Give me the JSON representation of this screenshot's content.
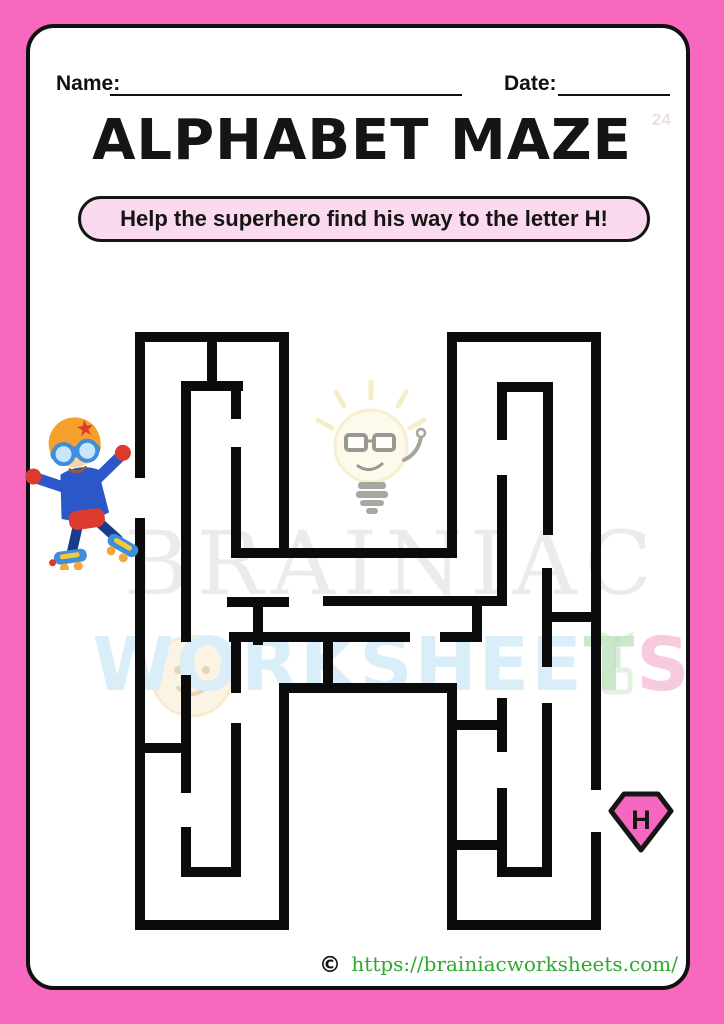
{
  "page": {
    "frame_color": "#F868BE",
    "card_bg": "#FFFFFF",
    "name_label": "Name:",
    "date_label": "Date:",
    "corner_number": "24",
    "title": "ALPHABET MAZE",
    "instruction": "Help the superhero find his way to the letter H!",
    "pill_bg": "#FBD9EE"
  },
  "watermark": {
    "line1": "BRAINIAC",
    "line2_main": "WORKSHEE",
    "line2_t": "T",
    "line2_s": "S"
  },
  "maze": {
    "letter_shape": "H",
    "wall_color": "#0B0B0B",
    "wall_width": 10,
    "entrance_side": "left",
    "exit_side": "right",
    "segments": [
      [
        140,
        337,
        284,
        337
      ],
      [
        140,
        337,
        140,
        473
      ],
      [
        140,
        523,
        140,
        925
      ],
      [
        140,
        925,
        284,
        925
      ],
      [
        284,
        337,
        284,
        553
      ],
      [
        284,
        553,
        452,
        553
      ],
      [
        452,
        337,
        452,
        553
      ],
      [
        452,
        337,
        596,
        337
      ],
      [
        596,
        337,
        596,
        785
      ],
      [
        596,
        837,
        596,
        925
      ],
      [
        452,
        925,
        596,
        925
      ],
      [
        452,
        688,
        452,
        925
      ],
      [
        284,
        688,
        452,
        688
      ],
      [
        284,
        688,
        284,
        925
      ],
      [
        212,
        337,
        212,
        386
      ],
      [
        188,
        386,
        238,
        386
      ],
      [
        236,
        386,
        236,
        414
      ],
      [
        186,
        386,
        186,
        637
      ],
      [
        236,
        452,
        236,
        553
      ],
      [
        236,
        553,
        284,
        553
      ],
      [
        140,
        748,
        186,
        748
      ],
      [
        186,
        680,
        186,
        788
      ],
      [
        236,
        728,
        236,
        872
      ],
      [
        186,
        872,
        236,
        872
      ],
      [
        186,
        832,
        186,
        872
      ],
      [
        232,
        602,
        284,
        602
      ],
      [
        258,
        602,
        258,
        640
      ],
      [
        234,
        637,
        405,
        637
      ],
      [
        236,
        637,
        236,
        688
      ],
      [
        328,
        601,
        502,
        601
      ],
      [
        328,
        637,
        328,
        688
      ],
      [
        477,
        601,
        477,
        637
      ],
      [
        445,
        637,
        477,
        637
      ],
      [
        502,
        387,
        502,
        435
      ],
      [
        502,
        387,
        548,
        387
      ],
      [
        548,
        387,
        548,
        530
      ],
      [
        502,
        480,
        502,
        601
      ],
      [
        547,
        573,
        547,
        662
      ],
      [
        547,
        617,
        596,
        617
      ],
      [
        452,
        725,
        502,
        725
      ],
      [
        502,
        703,
        502,
        747
      ],
      [
        452,
        845,
        502,
        845
      ],
      [
        502,
        793,
        502,
        872
      ],
      [
        502,
        872,
        547,
        872
      ],
      [
        547,
        708,
        547,
        872
      ]
    ]
  },
  "goal_badge": {
    "letter": "H",
    "fill": "#F767C0",
    "border": "#151515"
  },
  "icons": {
    "superhero": "rollerblading-superhero-kid",
    "bulb": "lightbulb-mascot-doodle",
    "face": "smiling-face-doodle",
    "sprout": "green-sprout-doodle"
  },
  "footer": {
    "copyright_symbol": "©",
    "url": "https://brainiacworksheets.com/",
    "url_color": "#2EA82E"
  }
}
